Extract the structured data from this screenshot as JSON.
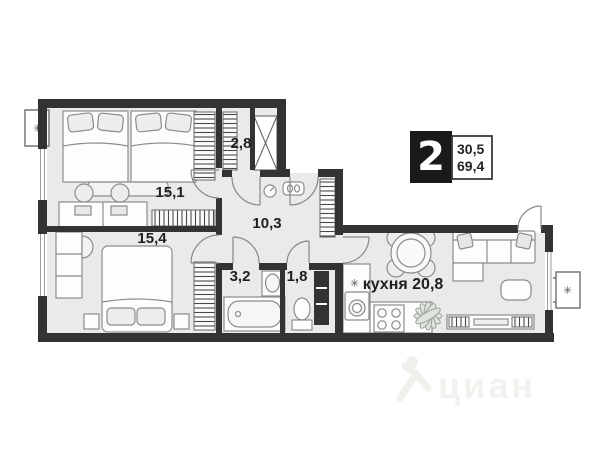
{
  "plan": {
    "badge": {
      "rooms_count": "2",
      "living_area": "30,5",
      "total_area": "69,4"
    },
    "rooms": [
      {
        "name": "bedroom-1",
        "label": "15,1"
      },
      {
        "name": "bedroom-2",
        "label": "15,4"
      },
      {
        "name": "closet",
        "label": "2,8"
      },
      {
        "name": "hallway",
        "label": "10,3"
      },
      {
        "name": "bathroom",
        "label": "3,2"
      },
      {
        "name": "wc",
        "label": "1,8"
      },
      {
        "name": "kitchen-living",
        "label": "кухня 20,8"
      }
    ],
    "symbols": {
      "vent": "✳",
      "sink": "✳"
    },
    "watermark": {
      "text": "циан"
    },
    "colors": {
      "wall": "#333333",
      "floor": "#eaeaea",
      "outline": "#8c8c8c",
      "label": "#1f1f1f",
      "watermark": "#f1f1ee"
    }
  }
}
